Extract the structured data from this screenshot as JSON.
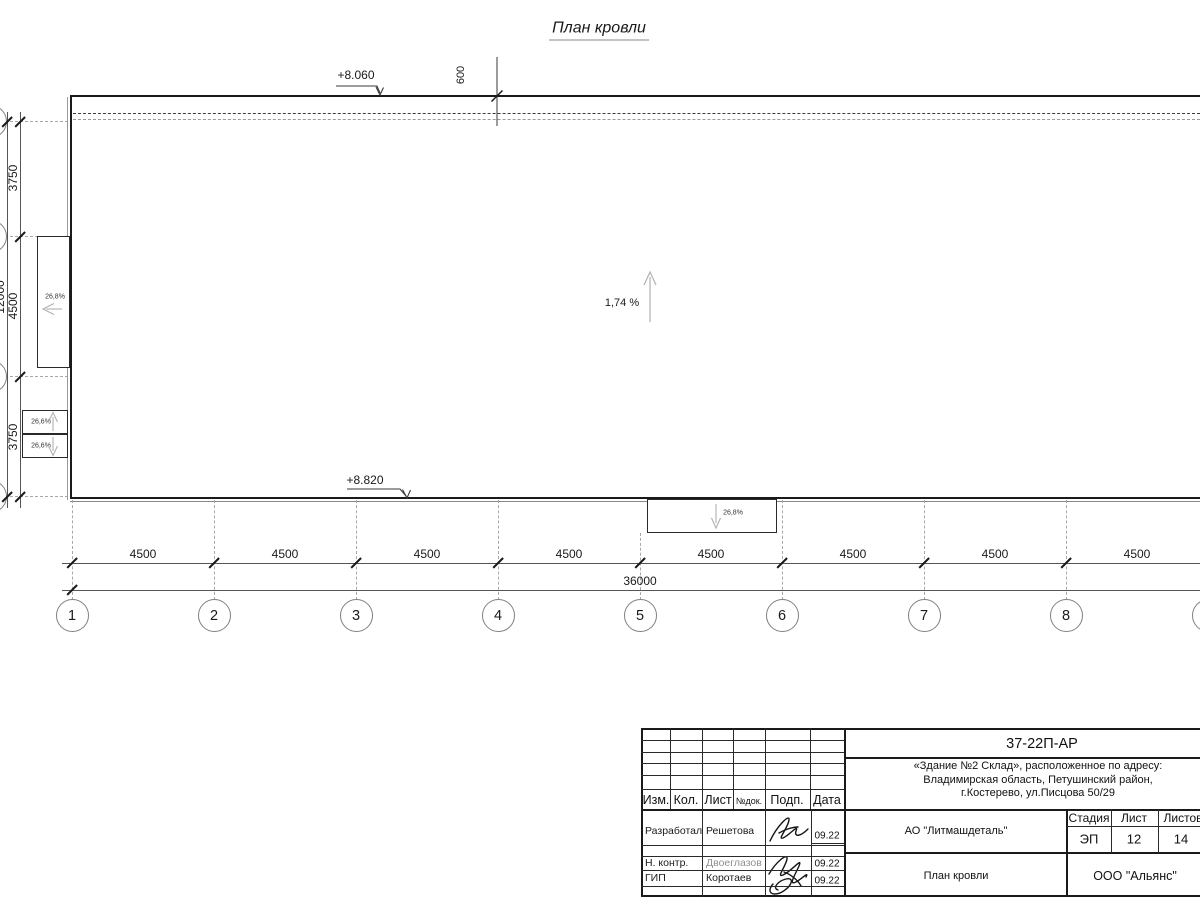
{
  "sheet": {
    "title": "План кровли"
  },
  "elevations": {
    "top_mark": "+8.060",
    "bottom_mark": "+8.820",
    "parapet_offset": "600"
  },
  "slopes": {
    "main": "1,74 %",
    "left_canopy": "26,8%",
    "left_lower_top": "26,6%",
    "left_lower_bottom": "26,6%",
    "bottom_canopy": "26,8%"
  },
  "dimensions": {
    "left_spans": [
      "3750",
      "4500",
      "3750"
    ],
    "left_total": "12000",
    "bottom_spans": [
      "4500",
      "4500",
      "4500",
      "4500",
      "4500",
      "4500",
      "4500",
      "4500"
    ],
    "bottom_total": "36000"
  },
  "axes": {
    "numbers": [
      "1",
      "2",
      "3",
      "4",
      "5",
      "6",
      "7",
      "8",
      "9"
    ]
  },
  "titleblock": {
    "doc_code": "37-22П-АР",
    "address": [
      "«Здание №2 Склад», расположенное по адресу:",
      "Владимирская область, Петушинский район,",
      "г.Костерево, ул.Писцова 50/29"
    ],
    "columns": {
      "izm": "Изм.",
      "kol": "Кол.",
      "list": "Лист",
      "doc": "№док.",
      "sign": "Подп.",
      "date": "Дата"
    },
    "rows": [
      {
        "role": "Разработал",
        "name": "Решетова",
        "date": "09.22"
      },
      {
        "role": "Н. контр.",
        "name": "Двоеглазов",
        "date": "09.22"
      },
      {
        "role": "ГИП",
        "name": "Коротаев",
        "date": "09.22"
      }
    ],
    "customer": "АО \"Литмашдеталь\"",
    "stage_label": "Стадия",
    "sheet_label": "Лист",
    "sheets_label": "Листов",
    "stage": "ЭП",
    "sheet_no": "12",
    "sheets_total": "14",
    "drawing_name": "План кровли",
    "contractor": "ООО \"Альянс\""
  },
  "colors": {
    "line": "#1a1a1a",
    "grid": "#9a9a9a",
    "slope_arrow": "#b0b0b0"
  }
}
